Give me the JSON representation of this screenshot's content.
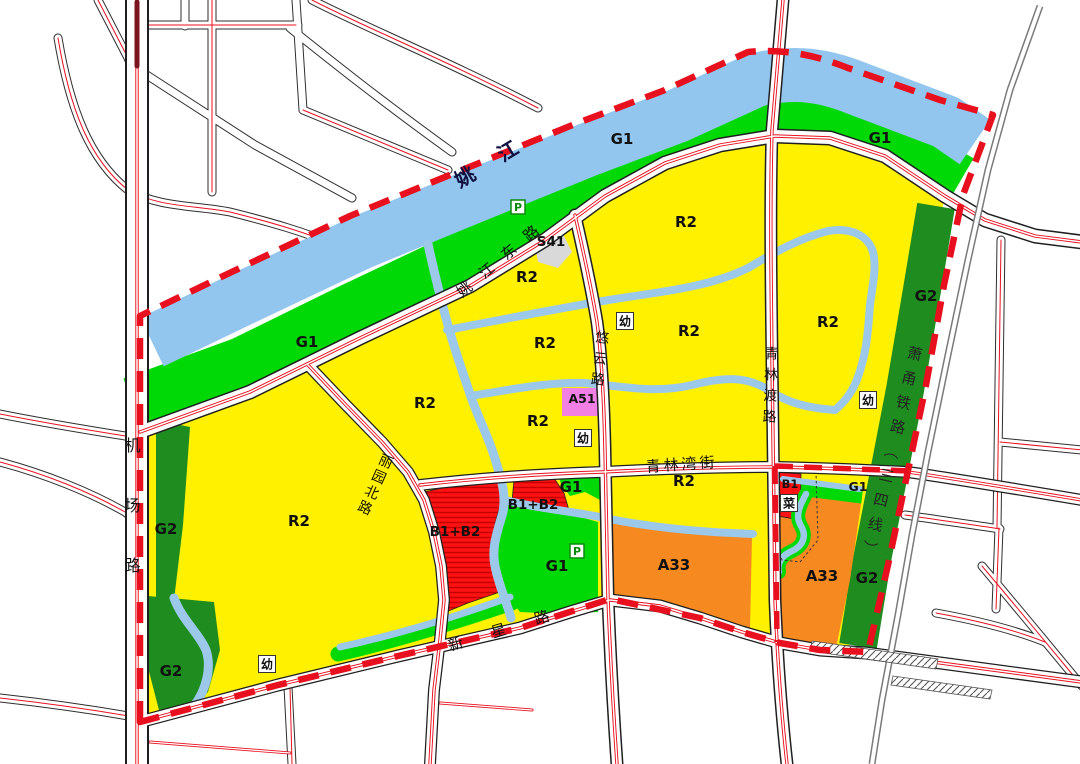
{
  "map": {
    "river": {
      "name": "姚江"
    },
    "railway": {
      "name": "萧甬铁路（三四线）"
    },
    "roads": {
      "jichang": "机场路",
      "yaojiangdong": "姚江东路",
      "youyun": "悠云路",
      "qinglindu": "青林渡路",
      "qinglinwan": "青林湾街",
      "liyuanbei": "丽园北路",
      "xinxing": "新星路"
    },
    "zone_codes": {
      "r2": "R2",
      "g1": "G1",
      "g2": "G2",
      "a33": "A33",
      "a51": "A51",
      "b1b2": "B1+B2",
      "b1": "B1",
      "s41": "S41"
    },
    "badges": {
      "kindergarten": "幼",
      "market": "菜",
      "parking": "P"
    },
    "colors": {
      "residential_r2_yellow": "#FFF100",
      "park_g1_green": "#00D905",
      "protective_g2_green": "#1E8C1E",
      "water_blue": "#93C6EF",
      "stream_blue": "#9CC9EA",
      "commercial_b1b2_red": "#FF1212",
      "public_a33_orange": "#F6891F",
      "sports_a51_pink": "#F27FE3",
      "transport_s41_gray": "#D9D9D9",
      "boundary_red_dashed": "#E8101E",
      "road_centerline_red": "#E8101E",
      "railway_gray": "#7A7A7A"
    }
  }
}
